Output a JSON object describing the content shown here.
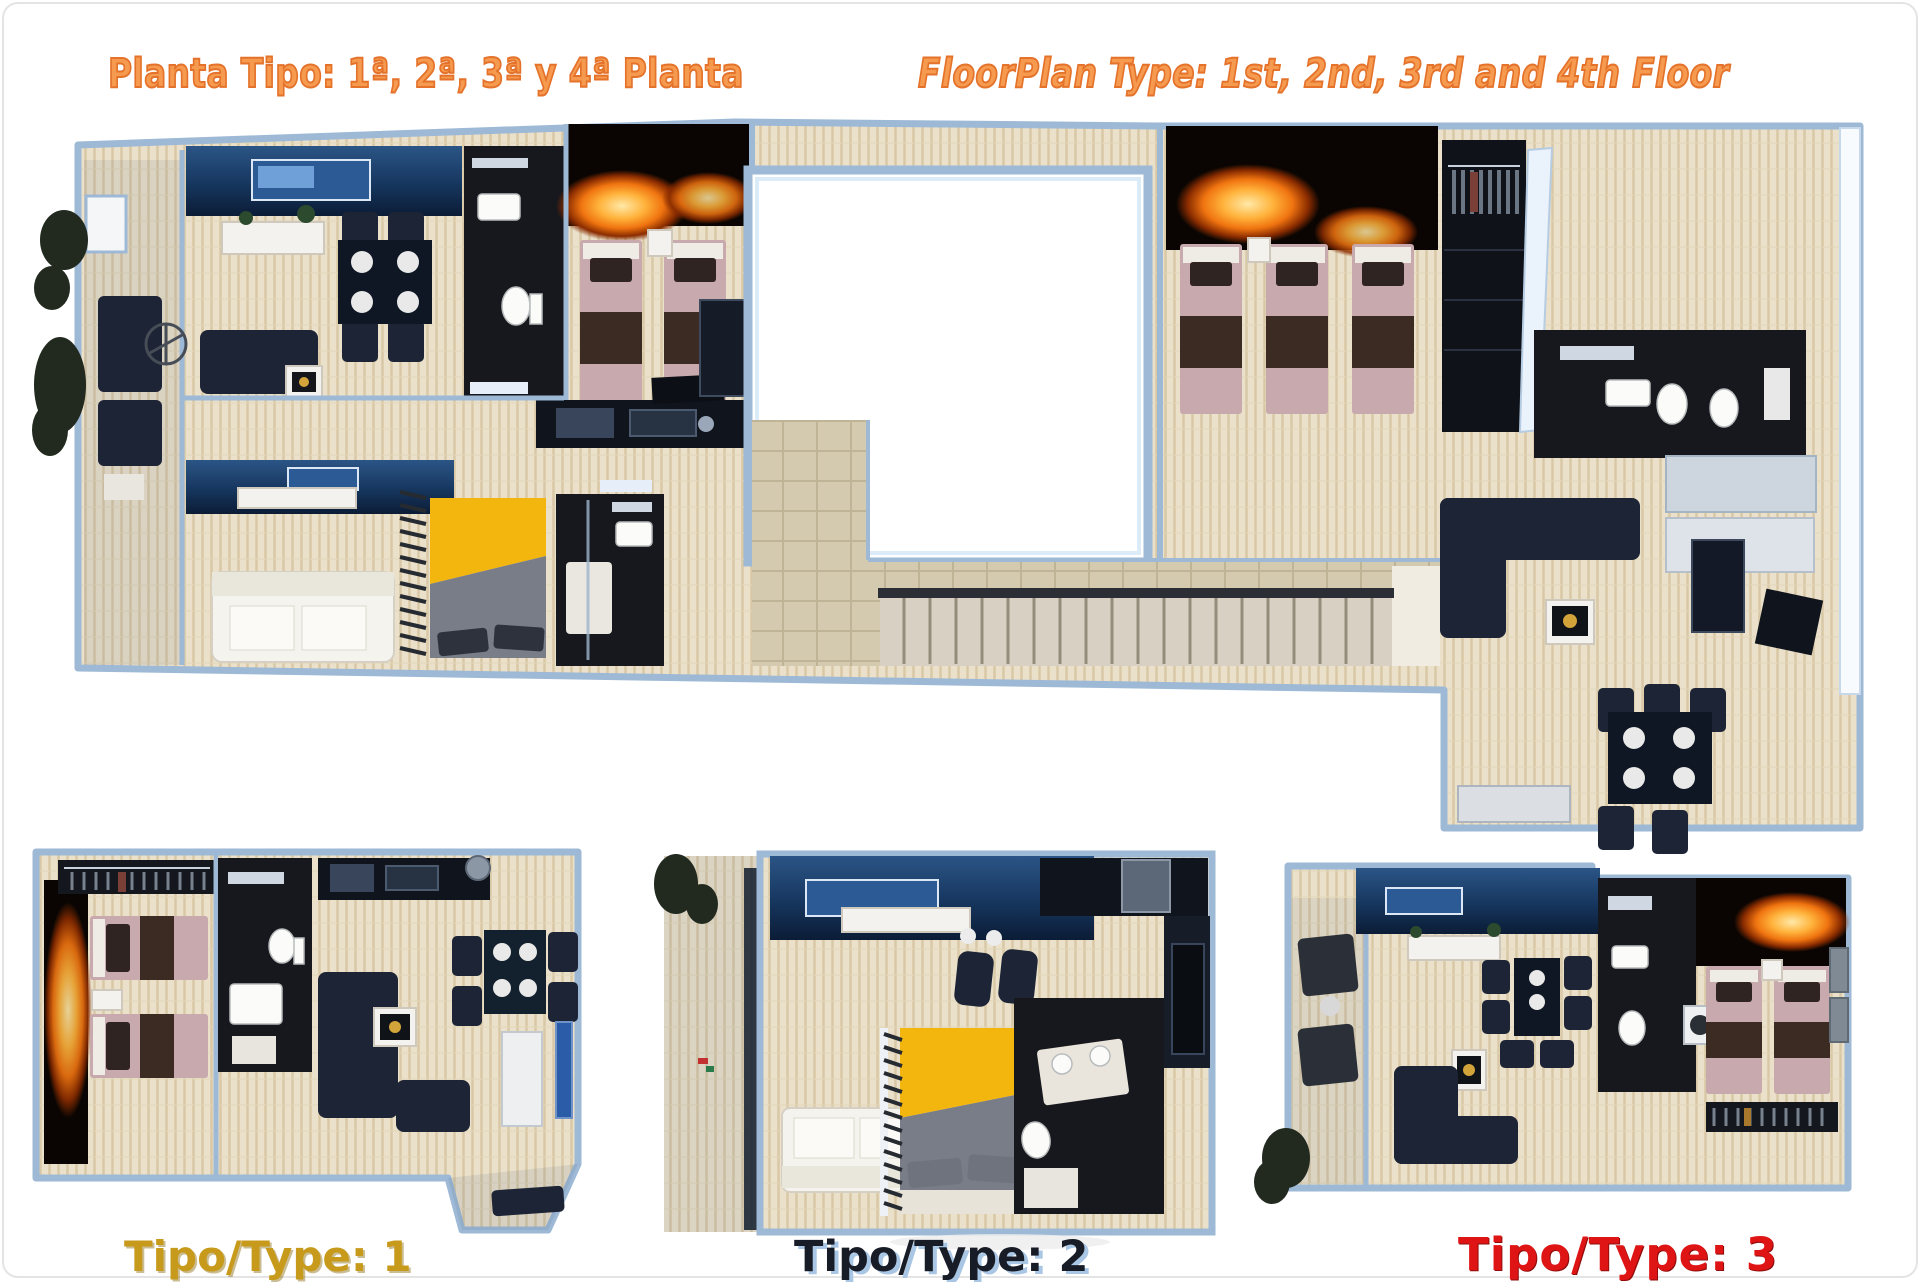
{
  "titles": {
    "es": "Planta Tipo: 1ª, 2ª, 3ª y 4ª Planta",
    "en": "FloorPlan Type: 1st, 2nd, 3rd and 4th Floor"
  },
  "plan_labels": {
    "type1": "Tipo/Type: 1",
    "type2": "Tipo/Type: 2",
    "type3": "Tipo/Type: 3"
  },
  "palette": {
    "title-fill": "#f59a4f",
    "title-stroke": "#e4722a",
    "gold-label": "#c79a1b",
    "navy-label": "#181c26",
    "navy-label-shadow": "#a9c6e4",
    "red-label": "#df1414",
    "wall": "#9db9d6",
    "wall-light": "#dcebf8",
    "floor": "#ebe1cb",
    "navy-furniture": "#1c2436",
    "accent-wall": "#16365e",
    "dark-room": "#17181d",
    "mauve-bed": "#c8a9ad",
    "brown-blanket": "#3c2b23",
    "yellow-bed": "#f2b60f",
    "white-furniture": "#f4f2ee",
    "fire-orange": "#f07410"
  }
}
